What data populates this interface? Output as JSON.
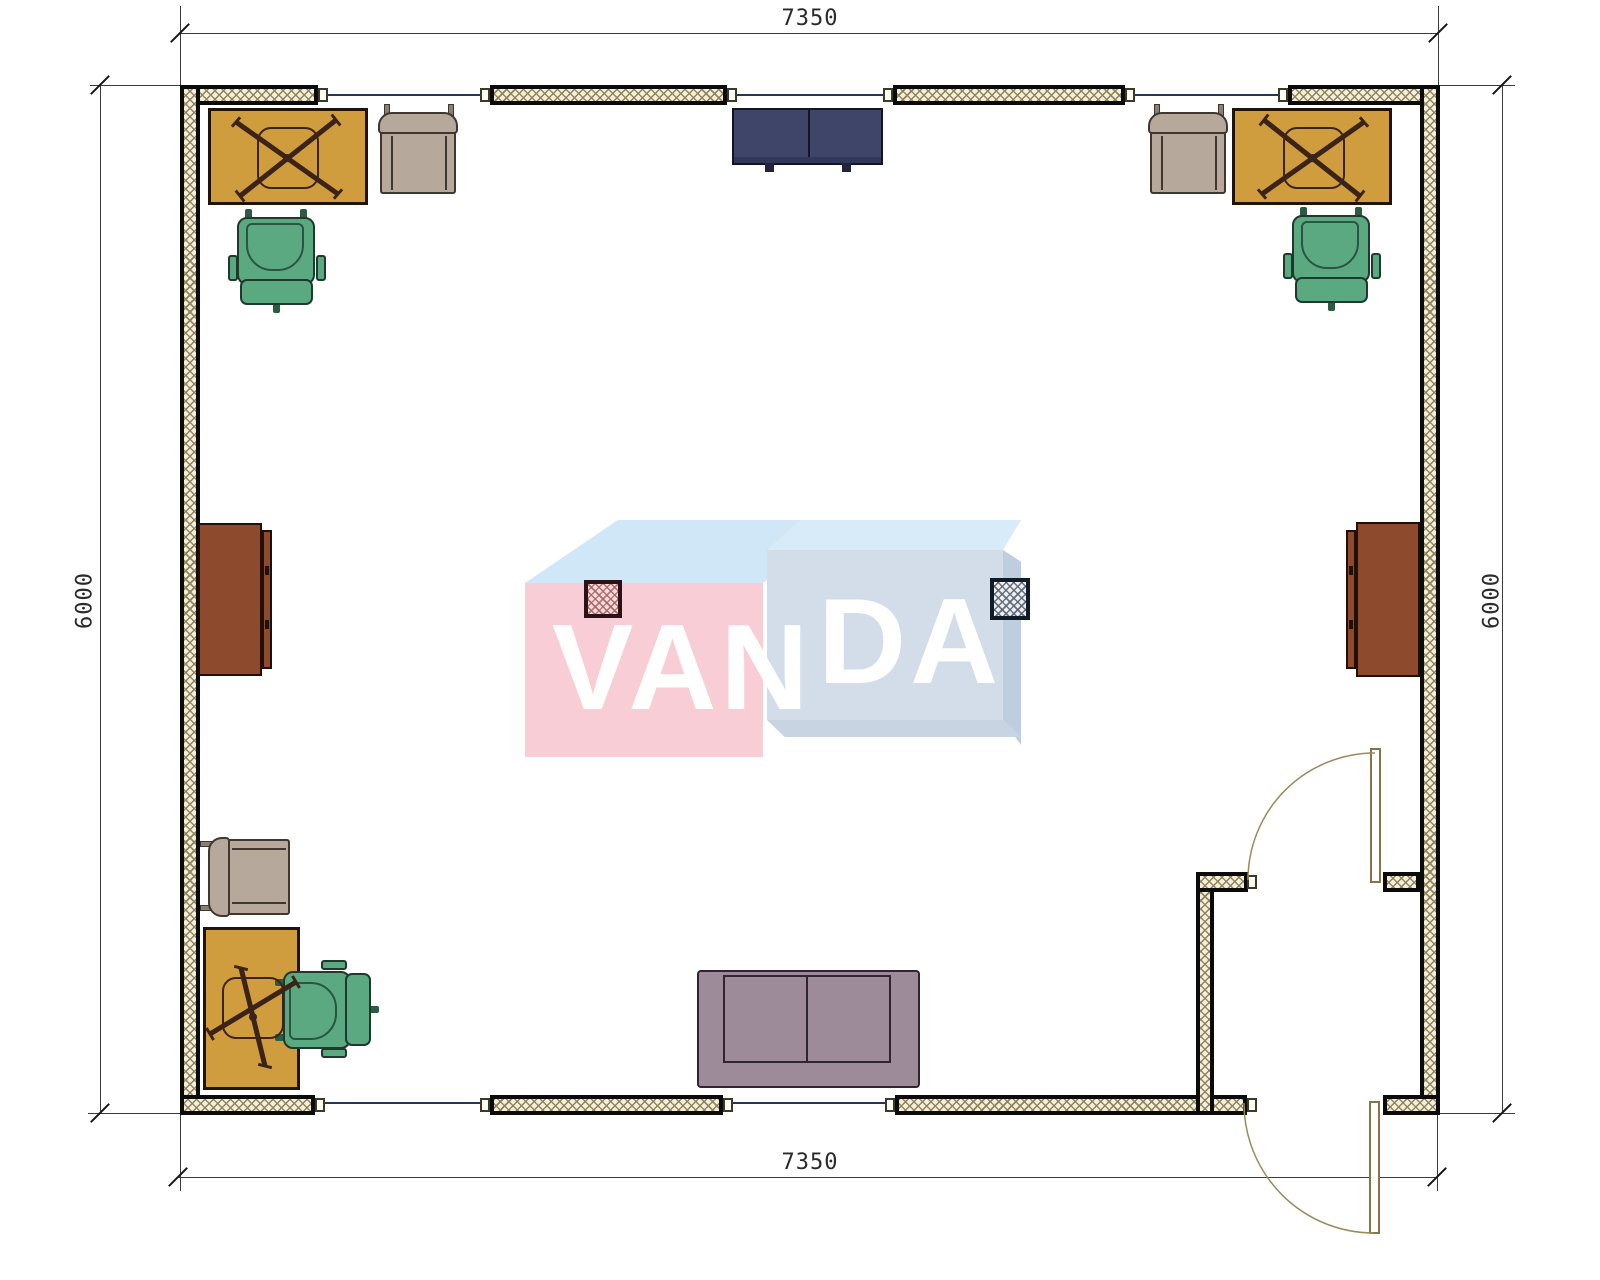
{
  "title": "room-floor-plan",
  "watermark": {
    "text": "VANDA",
    "part_left": "VAN",
    "part_right": "DA"
  },
  "dimensions": {
    "top_label": "7350",
    "bottom_label": "7350",
    "left_label": "6000",
    "right_label": "6000"
  },
  "furniture_inventory": {
    "desks": 3,
    "office_chairs_green": 3,
    "guest_chairs_beige": 3,
    "sideboards_brown": 2,
    "cabinet_navy": 1,
    "sofa": 1,
    "columns": 2,
    "windows": 5,
    "doors": 2
  },
  "colors": {
    "wall_hatch_line": "#8f8258",
    "desk": "#cf9c3e",
    "office_chair": "#5aa981",
    "guest_chair": "#b6a99b",
    "sideboard": "#8d4a2c",
    "cabinet_navy": "#3e4568",
    "sofa": "#9e8b99",
    "column_pink": "#f6dcdc",
    "column_blue": "#eceef0",
    "logo_pink": "#f9cdd5",
    "logo_blue": "#d3dce9",
    "window_glass": "#25355e"
  }
}
